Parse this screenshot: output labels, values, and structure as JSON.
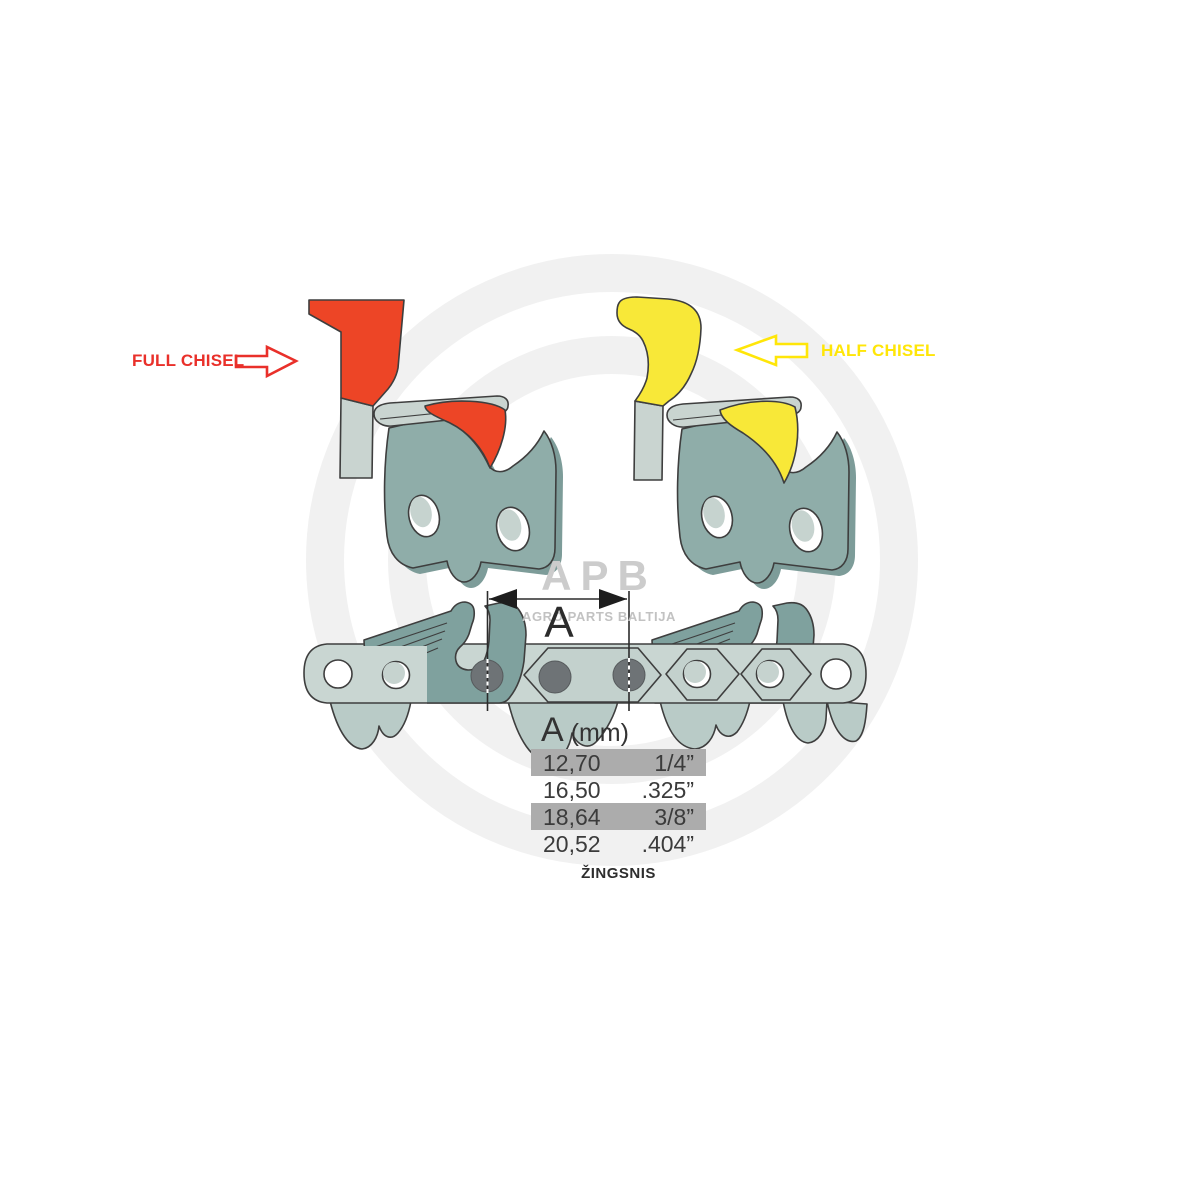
{
  "labels": {
    "full_chisel": "FULL CHISEL",
    "half_chisel": "HALF CHISEL",
    "dimension": "A",
    "pitch_caption": "ŽINGSNIS"
  },
  "watermark": {
    "logo": "APB",
    "subtitle": "AGRO PARTS BALTIJA"
  },
  "table": {
    "header_letter": "A",
    "header_unit": "(mm)",
    "rows": [
      {
        "mm": "12,70",
        "inch": "1/4”",
        "highlighted": true
      },
      {
        "mm": "16,50",
        "inch": ".325”",
        "highlighted": false
      },
      {
        "mm": "18,64",
        "inch": "3/8”",
        "highlighted": true
      },
      {
        "mm": "20,52",
        "inch": ".404”",
        "highlighted": false
      }
    ]
  },
  "colors": {
    "red_label": "#e9302a",
    "red_fill": "#ed4526",
    "yellow_label": "#ffe608",
    "yellow_fill": "#f8e838",
    "tooth": "#8fada9",
    "tooth_face": "#7d9c99",
    "cutter": "#7fa19e",
    "strap": "#c9d6d2",
    "hex": "#c3d1cd",
    "inner_link": "#b9cbc7",
    "hole_light": "#c6d3cf",
    "rivet": "#6e7376",
    "outline": "#3e3e3e",
    "shank": "#c9d4d0",
    "watermark_ring": "#f1f1f1",
    "watermark_text": "#cccccc",
    "watermark_sub": "#c2c2c2",
    "table_band": "#acacac",
    "ink": "#333333"
  }
}
